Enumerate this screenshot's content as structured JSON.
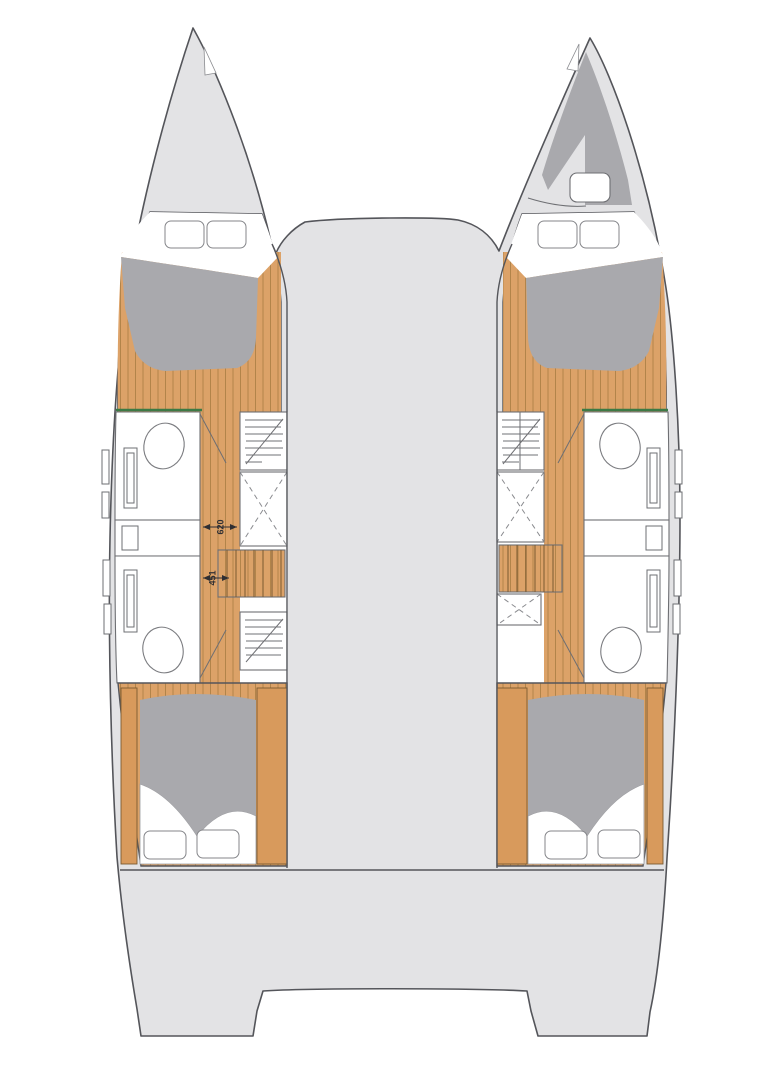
{
  "diagram": {
    "kind": "catamaran-deck-plan",
    "dimensions": {
      "corridor_forward": "620",
      "corridor_aft": "451"
    },
    "colors": {
      "deck": "#e3e3e5",
      "outline": "#54555a",
      "iline": "#6e6f73",
      "mattress": "#a9a9ad",
      "wood": "#dca268",
      "woodplain": "#d89a5c",
      "woodline": "#9a7138",
      "treadline": "#7a5a30",
      "green": "#3c7a45",
      "dimtext": "#2f2f33"
    }
  }
}
